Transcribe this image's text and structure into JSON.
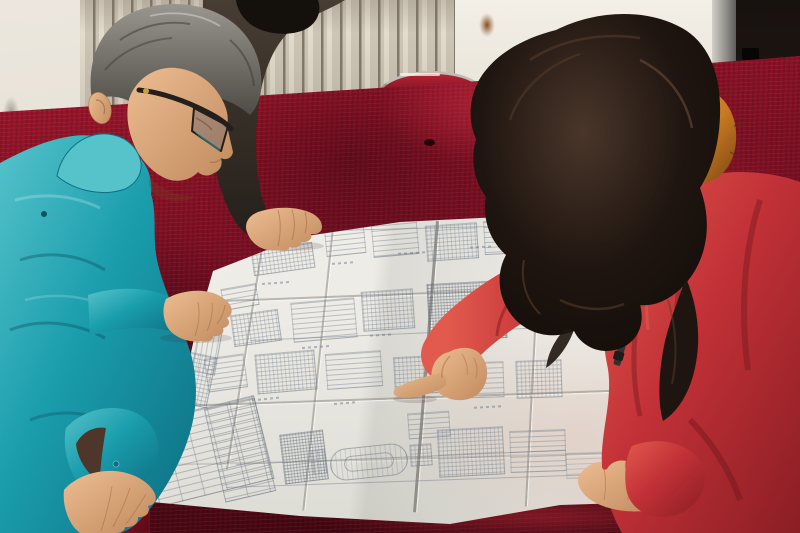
{
  "colors": {
    "wall_left": "#ece7de",
    "wall_right": "#f2efe7",
    "wall_lower": "#cfc8bb",
    "radiator_light": "#e3dccd",
    "radiator_mid": "#cdc5b5",
    "radiator_slat": "#81786a",
    "rust": "#8a4d20",
    "door_frame": "#8f8d88",
    "door_dark": "#18120f",
    "velvet": "#8c1126",
    "velvet_bright": "#ab1b31",
    "velvet_deep": "#2e040b",
    "chair_red": "#b22433",
    "chair_metal": "#c0bdb8",
    "paper": "#f3f2ee",
    "paper_shade": "#dcdbd4",
    "ink": "#707b8a",
    "teal": "#1a9dac",
    "teal_dark": "#0d6f82",
    "teal_light": "#56c3cb",
    "sleeve_gap": "#4e362a",
    "skin": "#edbd92",
    "skin_dark": "#c08a5e",
    "hair_gray": "#99968f",
    "hair_gray_dark": "#4f4b45",
    "hair_black": "#14100c",
    "jacket2": "#473d33",
    "jacket2_dark": "#241f1a",
    "hair_brown": "#1f1510",
    "hair_brown_light": "#4a362a",
    "fur": "#c97a22",
    "fur_light": "#e09a3c",
    "fur_dark": "#7c4612",
    "coat": "#c23137",
    "coat_dark": "#8a1e24",
    "coat_light": "#e15a4d",
    "glasses": "#241f1c"
  }
}
